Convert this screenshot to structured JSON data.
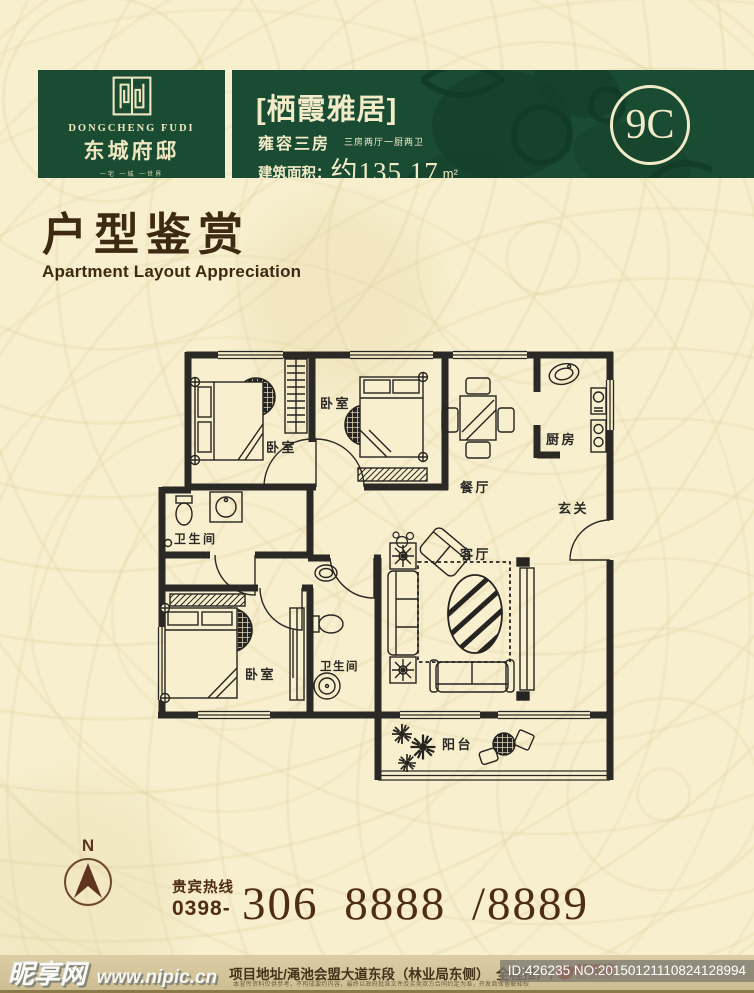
{
  "colors": {
    "header_green": "#1a4c33",
    "band_decor_green": "#153f2a",
    "cream_text": "#f2ebc8",
    "page_bg": "#f7efce",
    "heading_brown": "#3e2a12",
    "hotline_brown": "#4f2c15",
    "plan_ink": "#2b2925",
    "agency_red": "#cf1f16"
  },
  "header": {
    "logo": {
      "icon": "maze-seal-icon",
      "brand_en": "DONGCHENG FUDI",
      "brand_cn": "东城府邸",
      "tagline": "一宅 一城 一世界"
    },
    "band": {
      "title": "[栖霞雅居]",
      "subtitle": "雍容三房",
      "spec": "三房两厅一厨两卫",
      "area_label": "建筑面积：",
      "area_value": "约135.17",
      "area_unit": "m²",
      "unit_code": "9C"
    }
  },
  "section": {
    "title_cn": "户型鉴赏",
    "title_en": "Apartment Layout Appreciation"
  },
  "floorplan": {
    "labels": {
      "bedroom_top_left": "卧室",
      "bedroom_top_mid": "卧室",
      "dining": "餐厅",
      "kitchen": "厨房",
      "entry": "玄关",
      "living": "客厅",
      "bath_main": "卫生间",
      "bath_second": "卫生间",
      "bedroom_master": "卧室",
      "balcony": "阳台"
    }
  },
  "compass": {
    "label": "N"
  },
  "hotline": {
    "label": "贵宾热线",
    "prefix": "0398-",
    "number": "306 8888 /8889"
  },
  "footer": {
    "watermark_cn": "昵享网",
    "watermark_url": "www.nipic.cn",
    "address": "项目地址/渑池会盟大道东段（林业局东侧）　全程推广/",
    "agency_cn": "新视线",
    "agency_en": "NEW VISIONS",
    "fine_print": "本宣传资料仅供参考，不构成要约内容，最终以政府批准文件及买卖双方合同约定为准，开发商保留解释权",
    "id_text": "ID:426235 NO:20150121110824128994"
  }
}
